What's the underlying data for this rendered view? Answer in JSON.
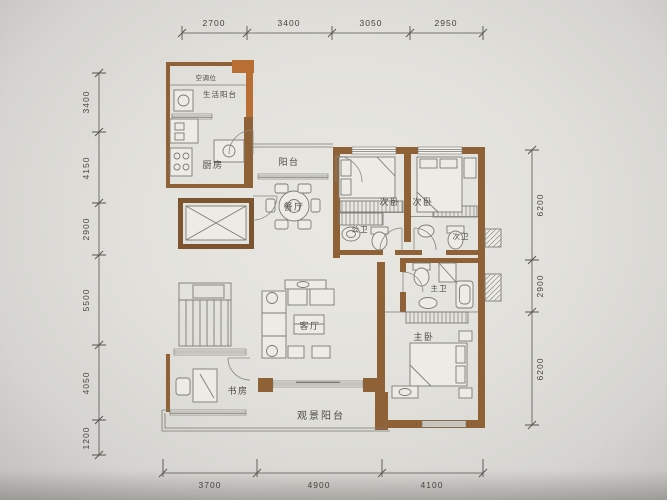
{
  "document": {
    "type": "apartment-floor-plan-photo",
    "colors": {
      "paper": "#e3e2dd",
      "wall_brown": "#8f6136",
      "wall_accent": "#b96f33",
      "line_gray": "#77756f",
      "dim_text": "#45443f"
    }
  },
  "rooms": {
    "ac_unit": "空调位",
    "service_balcony": "生活阳台",
    "kitchen": "厨房",
    "balcony": "阳台",
    "dining": "餐厅",
    "bedroom_left": "次卧",
    "bedroom_right": "次卧",
    "bath_public": "公卫",
    "bath_second": "次卫",
    "bath_master": "主卫",
    "bedroom_master": "主卧",
    "living": "客厅",
    "study": "书房",
    "view_balcony": "观景阳台"
  },
  "dimensions": {
    "top": [
      "2700",
      "3400",
      "3050",
      "2950"
    ],
    "left": [
      "3400",
      "4150",
      "2900",
      "5500",
      "4050",
      "1200"
    ],
    "right": [
      "6200",
      "2900",
      "6200"
    ],
    "bottom": [
      "3700",
      "4900",
      "4100"
    ]
  }
}
